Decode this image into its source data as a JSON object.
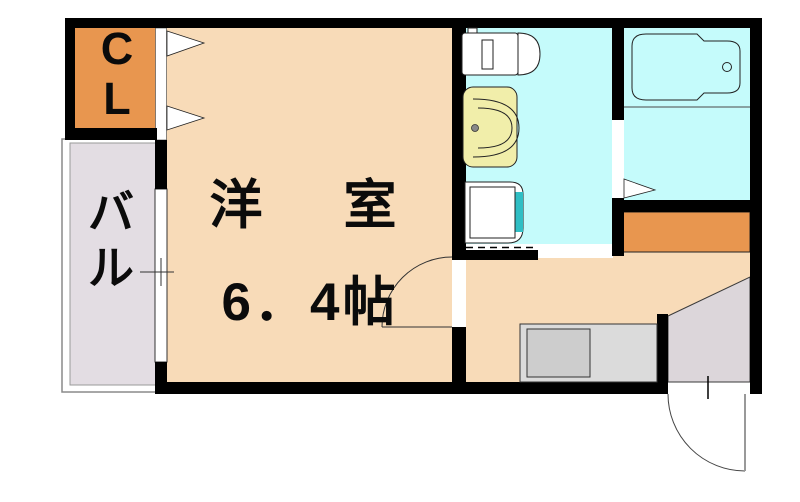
{
  "floorplan": {
    "labels": {
      "closet": "C\nL",
      "balcony": "バ\nル",
      "main_room_name": "洋　室",
      "main_room_size": "6．4帖"
    },
    "colors": {
      "wall": "#000000",
      "room_floor": "#F8DBB8",
      "closet": "#E8964F",
      "storage": "#E8964F",
      "wet_area": "#C5FBFB",
      "balcony": "#E3DDE3",
      "entrance": "#DCD6DA",
      "counter": "#DBDBDB",
      "counter_sink": "#CDCDCD",
      "sink_unit": "#F1EEAA",
      "washer_accent": "#2FBEC4"
    },
    "fixtures": [
      "toilet",
      "wash-basin",
      "washing-machine-space",
      "bathtub",
      "kitchen-counter",
      "entrance-door",
      "room-door",
      "closet-folding-door",
      "bath-folding-door",
      "balcony-window"
    ]
  }
}
